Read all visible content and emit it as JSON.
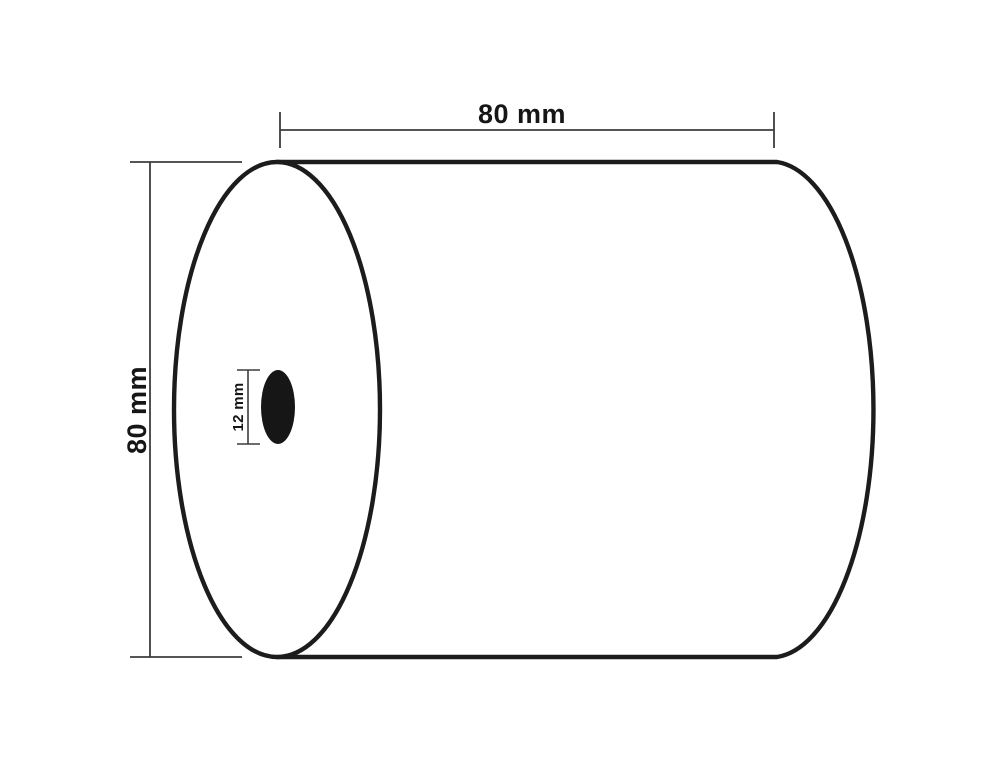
{
  "diagram": {
    "kind": "paper-roll dimension drawing",
    "labels": {
      "width": "80 mm",
      "diameter": "80 mm",
      "core": "12 mm"
    },
    "colors": {
      "background": "#ffffff",
      "outline": "#1c1c1c",
      "dimension_line": "#3d3d3d",
      "text": "#161616",
      "core_fill": "#161616"
    }
  }
}
